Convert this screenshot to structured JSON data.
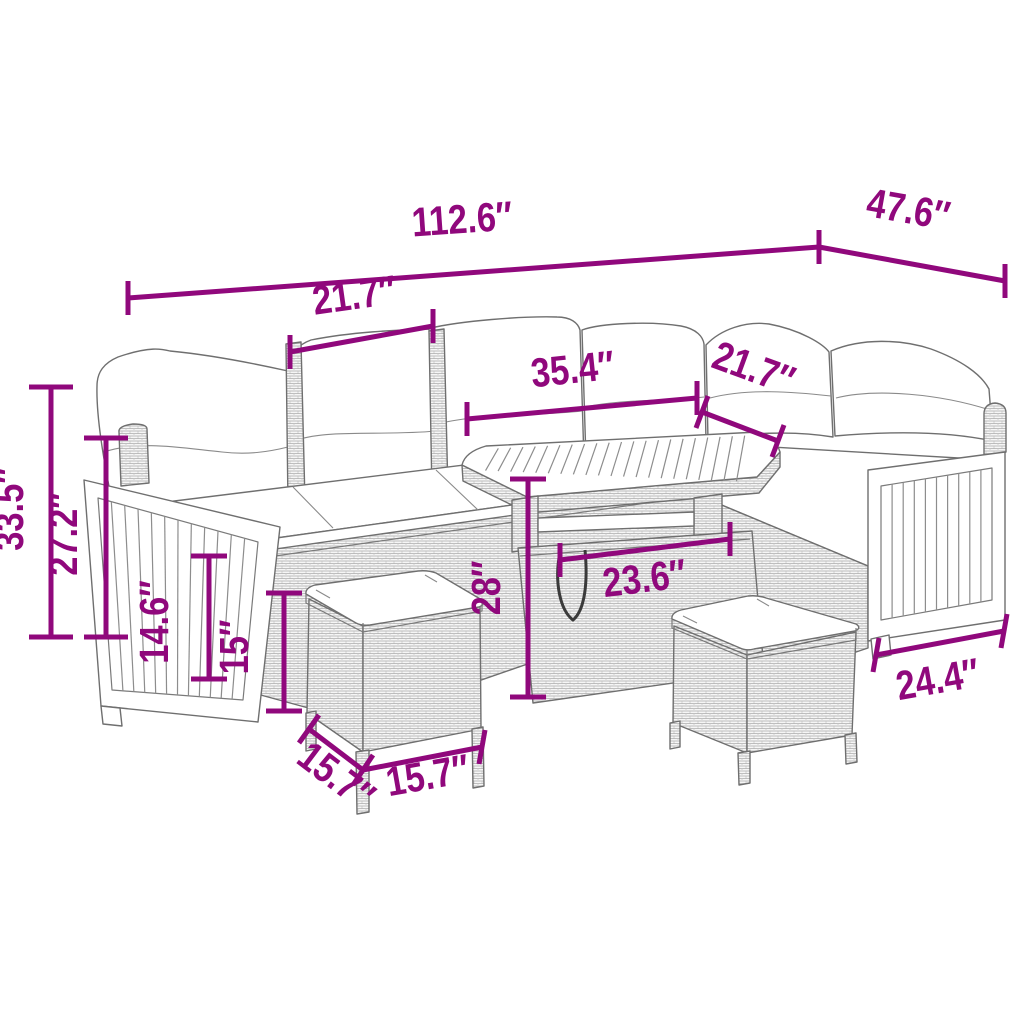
{
  "meta": {
    "diagram_type": "product dimension line-drawing",
    "product": "rattan garden lounge set with acacia wood panels, table and two stools",
    "unit": "inches",
    "accent_color": "#90087C",
    "drawing_line_color": "#6f6f6f",
    "background_color": "#ffffff"
  },
  "dimensions": {
    "total_width": "112.6″",
    "total_depth": "47.6″",
    "seat_width": "21.7″",
    "table_length": "35.4″",
    "corner_seat_width": "21.7″",
    "total_height": "33.5″",
    "back_height": "27.2″",
    "base_height": "14.6″",
    "stool_height": "15″",
    "table_height": "28″",
    "table_width": "23.6″",
    "arm_depth": "24.4″",
    "stool_depth": "15.7″",
    "stool_width": "15.7″"
  }
}
